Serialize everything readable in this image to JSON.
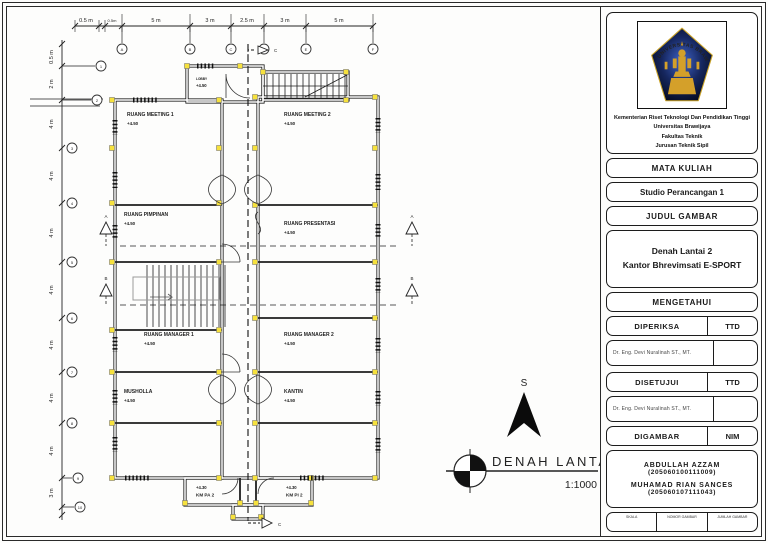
{
  "plan": {
    "drawing_title": "DENAH LANTAI 2",
    "drawing_scale": "1:1000",
    "north_label": "S",
    "rooms": [
      {
        "name": "RUANG MEETING 1",
        "elev": "+4.50"
      },
      {
        "name": "RUANG MEETING 2",
        "elev": "+4.50"
      },
      {
        "name": "LOBBY",
        "elev": "+4.50"
      },
      {
        "name": "RUANG PIMPINAN",
        "elev": "+4.50"
      },
      {
        "name": "RUANG PRESENTASI",
        "elev": "+4.50"
      },
      {
        "name": "RUANG MANAGER 1",
        "elev": "+4.50"
      },
      {
        "name": "RUANG MANAGER 2",
        "elev": "+4.50"
      },
      {
        "name": "MUSHOLLA",
        "elev": "+4.50"
      },
      {
        "name": "KANTIN",
        "elev": "+4.50"
      },
      {
        "name": "KM PA 2",
        "elev": "+4.30"
      },
      {
        "name": "KM PI 2",
        "elev": "+4.30"
      }
    ],
    "top_dims": [
      "0.5 m",
      "0.5m",
      "5 m",
      "3 m",
      "2.5 m",
      "3 m",
      "5 m"
    ],
    "left_dims": [
      "0.5 m",
      "2 m",
      "4 m",
      "4 m",
      "4 m",
      "4 m",
      "4 m",
      "4 m",
      "4 m",
      "3 m"
    ],
    "grid_cols": [
      "A",
      "B",
      "C",
      "D",
      "E",
      "F"
    ],
    "grid_rows": [
      "1",
      "2",
      "3",
      "4",
      "5",
      "6",
      "7",
      "8",
      "9",
      "10"
    ],
    "sections": {
      "a": "A",
      "b": "B",
      "c": "C"
    },
    "column_color": "#f6e13d"
  },
  "titleblock": {
    "logo_text": "UNIVERSITAS BRAWIJAYA",
    "institution": [
      "Kementerian Riset Teknologi Dan Pendidikan Tinggi",
      "Universitas Brawijaya",
      "Fakultas Teknik",
      "Jurusan Teknik Sipil"
    ],
    "mata_kuliah_label": "MATA KULIAH",
    "mata_kuliah_value": "Studio Perancangan 1",
    "judul_gambar_label": "JUDUL GAMBAR",
    "judul_line1": "Denah Lantai 2",
    "judul_line2": "Kantor Bhrevimsati E-SPORT",
    "mengetahui": "MENGETAHUI",
    "diperiksa": "DIPERIKSA",
    "disetujui": "DISETUJUI",
    "digambar": "DIGAMBAR",
    "ttd": "TTD",
    "nim": "NIM",
    "examiner": "Dr. Eng. Devi Nuralinah ST., MT.",
    "approver": "Dr. Eng. Devi Nuralinah ST., MT.",
    "authors": [
      {
        "name": "ABDULLAH AZZAM",
        "nim": "(205060100111009)"
      },
      {
        "name": "MUHAMAD RIAN SANCES",
        "nim": "(205060107111043)"
      }
    ],
    "footer_cols": [
      "SKALA",
      "NOMOR GAMBAR",
      "JUMLAH GAMBAR"
    ]
  }
}
